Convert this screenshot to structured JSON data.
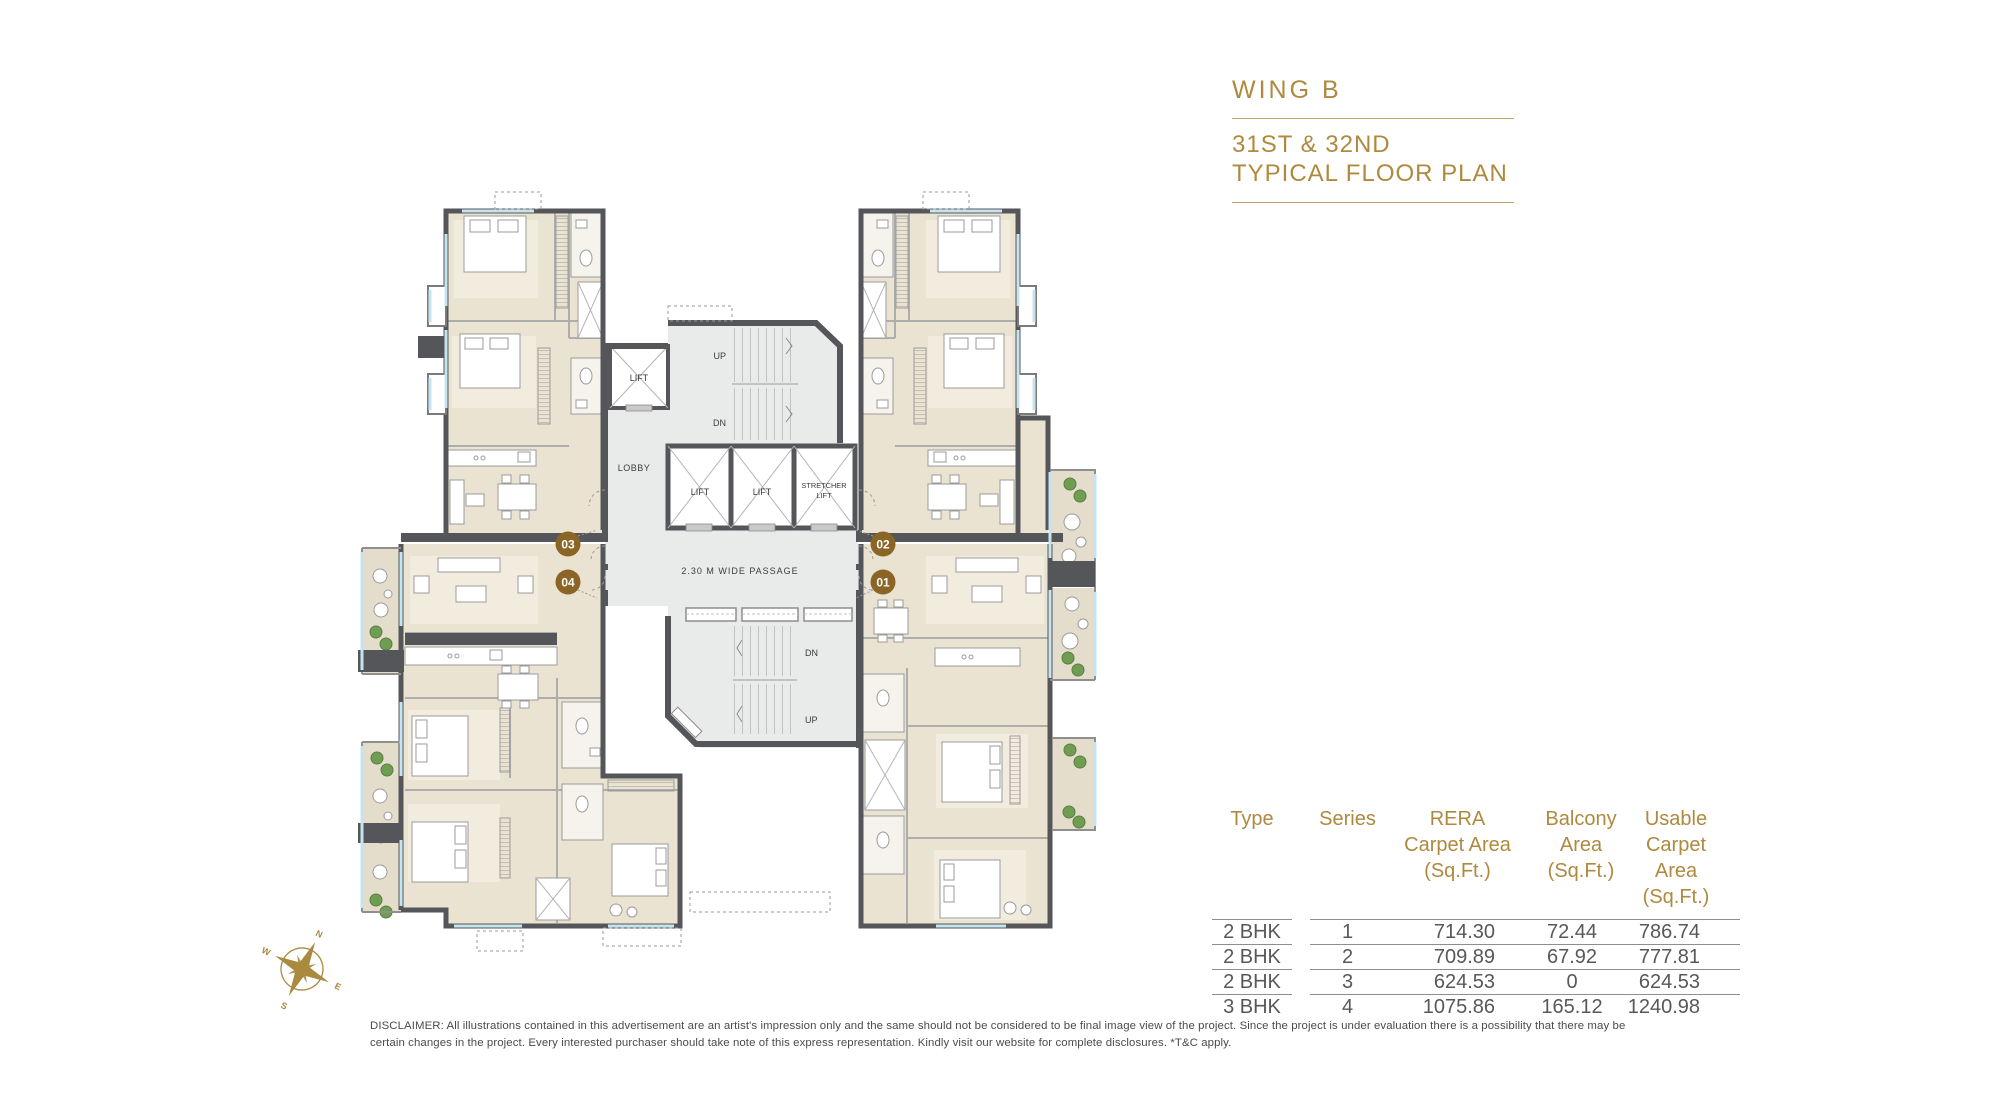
{
  "title": {
    "wing": "WING  B",
    "line1": "31ST & 32ND",
    "line2": "TYPICAL FLOOR PLAN"
  },
  "plan": {
    "lift_small": "LIFT",
    "lobby": "LOBBY",
    "lift_1": "LIFT",
    "lift_2": "LIFT",
    "stretcher_1": "STRETCHER",
    "stretcher_2": "LIFT",
    "up_top": "UP",
    "dn_top": "DN",
    "passage": "2.30 M WIDE PASSAGE",
    "dn_bottom": "DN",
    "up_bottom": "UP",
    "units": {
      "u01": "01",
      "u02": "02",
      "u03": "03",
      "u04": "04"
    }
  },
  "compass": {
    "n": "N",
    "e": "E",
    "s": "S",
    "w": "W"
  },
  "table": {
    "headers": {
      "type": "Type",
      "series": "Series",
      "rera": [
        "RERA",
        "Carpet Area",
        "(Sq.Ft.)"
      ],
      "balcony": [
        "Balcony",
        "Area",
        "(Sq.Ft.)"
      ],
      "usable": [
        "Usable",
        "Carpet Area",
        "(Sq.Ft.)"
      ]
    },
    "rows": [
      {
        "type": "2 BHK",
        "series": "1",
        "rera": "714.30",
        "balcony": "72.44",
        "usable": "786.74"
      },
      {
        "type": "2 BHK",
        "series": "2",
        "rera": "709.89",
        "balcony": "67.92",
        "usable": "777.81"
      },
      {
        "type": "2 BHK",
        "series": "3",
        "rera": "624.53",
        "balcony": "0",
        "usable": "624.53"
      },
      {
        "type": "3 BHK",
        "series": "4",
        "rera": "1075.86",
        "balcony": "165.12",
        "usable": "1240.98"
      }
    ]
  },
  "disclaimer": "DISCLAIMER: All illustrations contained in this advertisement are an artist's impression only and the same should not be considered to be final image view of the project. Since the project is under evaluation there is a possibility that there may be certain changes in the project. Every interested purchaser should take note of this express representation. Kindly visit our website for complete disclosures. *T&C apply.",
  "colors": {
    "gold": "#AF8A3E",
    "rule_gold": "#C2A264",
    "unit_badge": "#8A6526",
    "wall": "#55565A",
    "apartment_floor": "#EAE3D1",
    "core_floor": "#E9EAEA",
    "plant_green": "#6F9D52",
    "window_blue": "#C5E4F0",
    "text_gray": "#57585A"
  }
}
